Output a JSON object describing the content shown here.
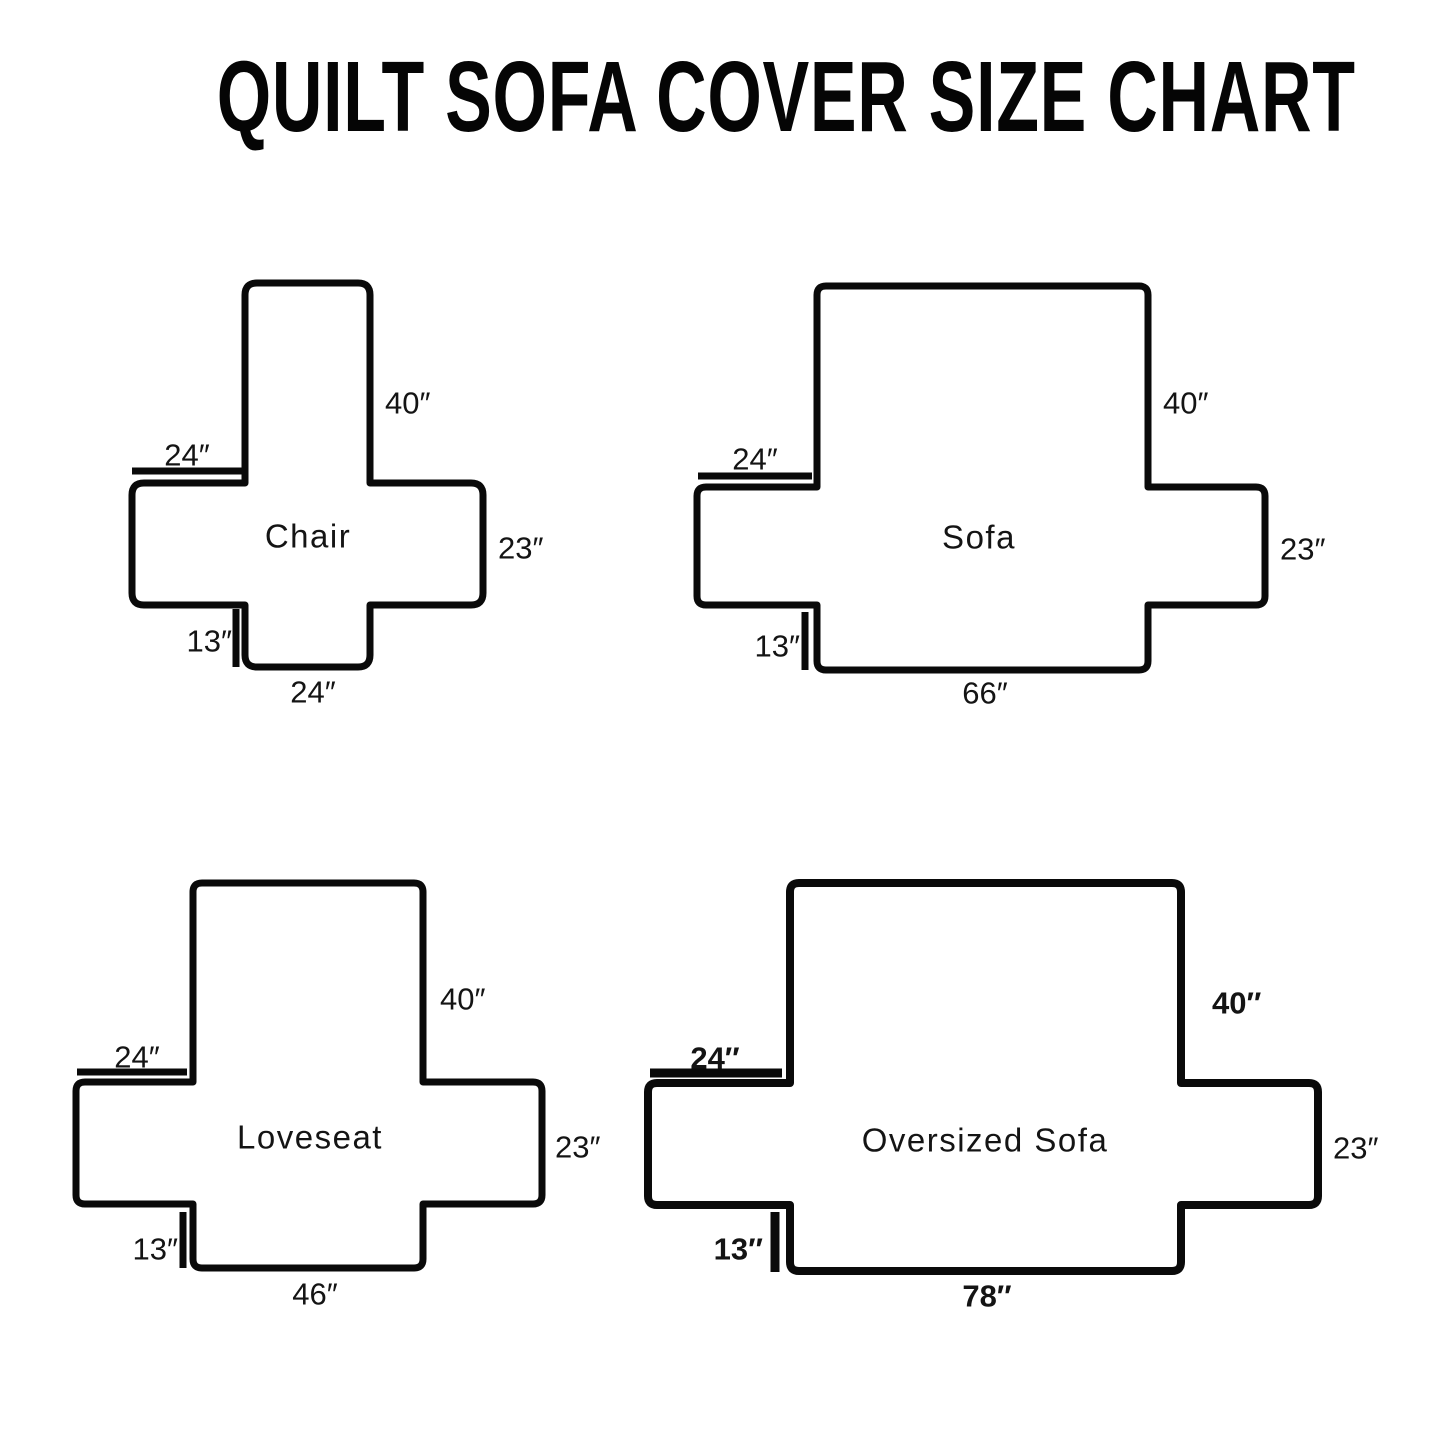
{
  "title": "QUILT SOFA COVER SIZE CHART",
  "diagrams": [
    {
      "name": "Chair",
      "back_height": "40″",
      "back_top_width": "24″",
      "arm_depth": "23″",
      "front_skirt_drop": "13″",
      "seat_bottom_width": "24″"
    },
    {
      "name": "Sofa",
      "back_height": "40″",
      "back_top_width": "24″",
      "arm_depth": "23″",
      "front_skirt_drop": "13″",
      "seat_bottom_width": "66″"
    },
    {
      "name": "Loveseat",
      "back_height": "40″",
      "back_top_width": "24″",
      "arm_depth": "23″",
      "front_skirt_drop": "13″",
      "seat_bottom_width": "46″"
    },
    {
      "name": "Oversized Sofa",
      "back_height": "40″",
      "back_top_width": "24″",
      "arm_depth": "23″",
      "front_skirt_drop": "13″",
      "seat_bottom_width": "78″"
    }
  ]
}
